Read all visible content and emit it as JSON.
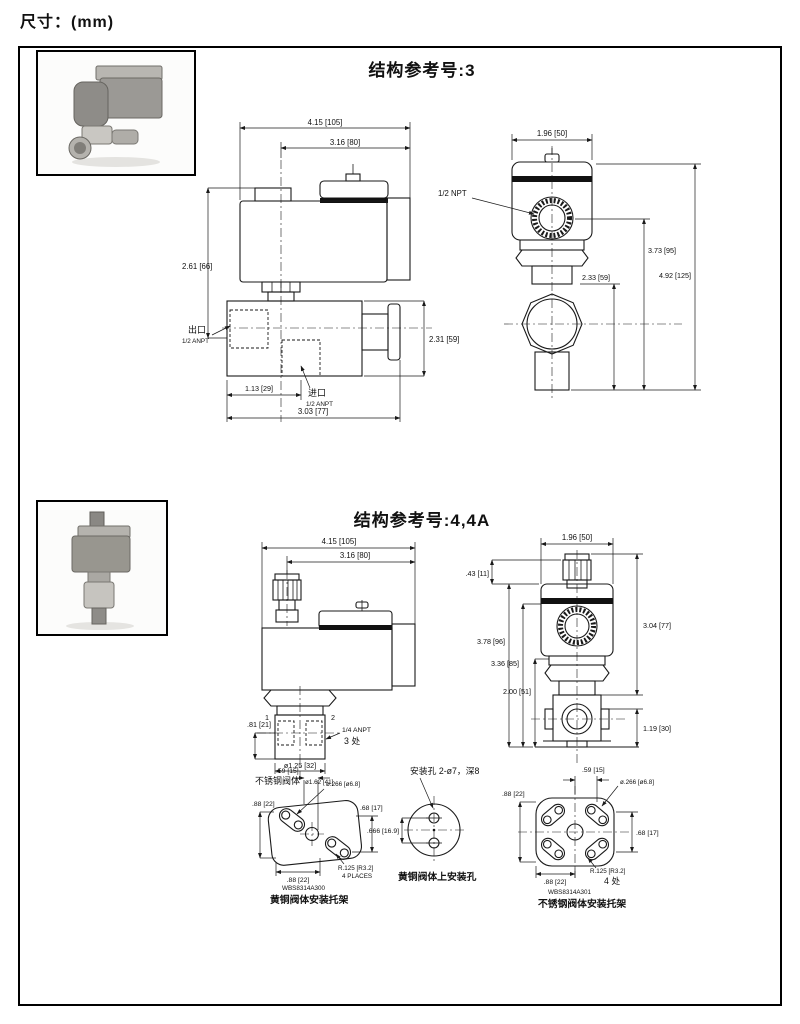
{
  "page": {
    "units_label": "尺寸：(mm)"
  },
  "section3": {
    "title": "结构参考号:3",
    "side": {
      "w_total": "4.15 [105]",
      "w_coil": "3.16 [80]",
      "h_coil": "2.61 [66]",
      "h_body": "2.31 [59]",
      "inlet_off": "1.13 [29]",
      "l_body": "3.03 [77]",
      "outlet": "出口",
      "outlet_size": "1/2 ANPT",
      "inlet": "进口",
      "inlet_size": "1/2 ANPT"
    },
    "front": {
      "w": "1.96 [50]",
      "conduit": "1/2 NPT",
      "h_port": "3.73 [95]",
      "h_nut": "2.33 [59]",
      "h_total": "4.92 [125]"
    }
  },
  "section4": {
    "title": "结构参考号:4,4A",
    "side": {
      "w_total": "4.15 [105]",
      "w_coil": "3.16 [80]",
      "h_port": ".81 [21]",
      "port1": "1",
      "port2": "2",
      "ports_label": "1/4 ANPT",
      "ports_count": "3 处",
      "d_body": "ø1.25 [32]",
      "body_note": "不锈钢阀体",
      "body_note_dim": "ø1.62 [41]"
    },
    "front": {
      "w": "1.96 [50]",
      "h_knob": ".43 [11]",
      "h1": "3.78 [96]",
      "h2": "3.36 [85]",
      "h3": "2.00 [51]",
      "h4": "3.04 [77]",
      "h5": "1.19 [30]"
    }
  },
  "brackets": {
    "brass": {
      "top": ".59 [15]",
      "hole": "ø.266 [ø6.8]",
      "left": ".88 [22]",
      "right": ".68 [17]",
      "bottom": ".88 [22]",
      "radius": "R.125 [R3.2]",
      "radius_note": "4 PLACES",
      "part_no": "WBS8314A300",
      "caption": "黄铜阀体安装托架"
    },
    "holes": {
      "label": "安装孔 2-ø7，深8",
      "dim": ".666 [16.9]",
      "caption": "黄铜阀体上安装孔"
    },
    "ss": {
      "top": ".59 [15]",
      "hole": "ø.266 [ø6.8]",
      "left": ".88 [22]",
      "right": ".68 [17]",
      "bottom": ".88 [22]",
      "radius": "R.125 [R3.2]",
      "radius_note": "4 处",
      "part_no": "WBS8314A301",
      "caption": "不锈钢阀体安装托架"
    }
  }
}
